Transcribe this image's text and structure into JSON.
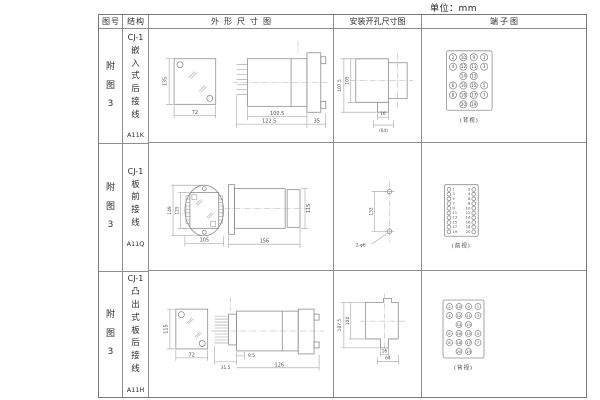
{
  "unit_label": "单位：mm",
  "header": {
    "col_figure": "图号",
    "col_structure": "结构",
    "col_outline": "外形尺寸图",
    "col_install": "安装开孔尺寸图",
    "col_terminal": "端子图"
  },
  "rows": [
    {
      "figure_no": "附图3",
      "structure": {
        "model": "CJ-1",
        "mount_type": "嵌入式后接线",
        "code": "A11K"
      },
      "outline": {
        "front_height": "135",
        "front_width": "72",
        "depth_body": "100.5",
        "depth_total": "122.5",
        "flange_width": "35"
      },
      "install": {
        "dim_outer_height": "107.5",
        "dim_inner_height": "105",
        "dim_slot_width": "16",
        "dim_base_width": "(64)"
      },
      "terminal": {
        "view_label": "(背视)",
        "grid": [
          [
            "2",
            "10",
            "9",
            "1"
          ],
          [
            "4",
            "12",
            "11",
            "3"
          ],
          [
            "",
            "14",
            "13",
            ""
          ],
          [
            "6",
            "16",
            "15",
            "5"
          ],
          [
            "8",
            "18",
            "17",
            "7"
          ],
          [
            "",
            "20",
            "19",
            ""
          ]
        ]
      }
    },
    {
      "figure_no": "附图3",
      "structure": {
        "model": "CJ-1",
        "mount_type": "板前接线",
        "code": "A11Q"
      },
      "outline": {
        "front_height_outer": "149",
        "front_height_inner": "125",
        "front_width": "105",
        "depth_total": "156",
        "side_height": "115"
      },
      "install": {
        "hole_pitch": "133",
        "hole_spec": "2-φ6"
      },
      "terminal": {
        "view_label": "(前视)",
        "pairs": [
          [
            "1",
            "2"
          ],
          [
            "3",
            "4"
          ],
          [
            "5",
            "6"
          ],
          [
            "7",
            "8"
          ],
          [
            "9",
            "10"
          ],
          [
            "11",
            "12"
          ],
          [
            "13",
            "14"
          ],
          [
            "15",
            "16"
          ],
          [
            "17",
            "18"
          ],
          [
            "19",
            "20"
          ]
        ]
      }
    },
    {
      "figure_no": "附图3",
      "structure": {
        "model": "CJ-1",
        "mount_type": "凸出式板后接线",
        "code": "A11H"
      },
      "outline": {
        "front_height": "115",
        "front_width": "72",
        "pin_depth": "31.5",
        "pin_pitch": "9.5",
        "depth_total": "126"
      },
      "install": {
        "dim_outer_height": "107.5",
        "dim_inner_height": "104",
        "dim_slot_width": "16",
        "dim_base_width": "64"
      },
      "terminal": {
        "view_label": "(背视)",
        "grid": [
          [
            "2",
            "10",
            "9",
            "1"
          ],
          [
            "4",
            "12",
            "11",
            "3"
          ],
          [
            "",
            "14",
            "13",
            ""
          ],
          [
            "6",
            "16",
            "15",
            "5"
          ],
          [
            "8",
            "18",
            "17",
            "7"
          ],
          [
            "",
            "20",
            "19",
            ""
          ]
        ]
      }
    }
  ]
}
